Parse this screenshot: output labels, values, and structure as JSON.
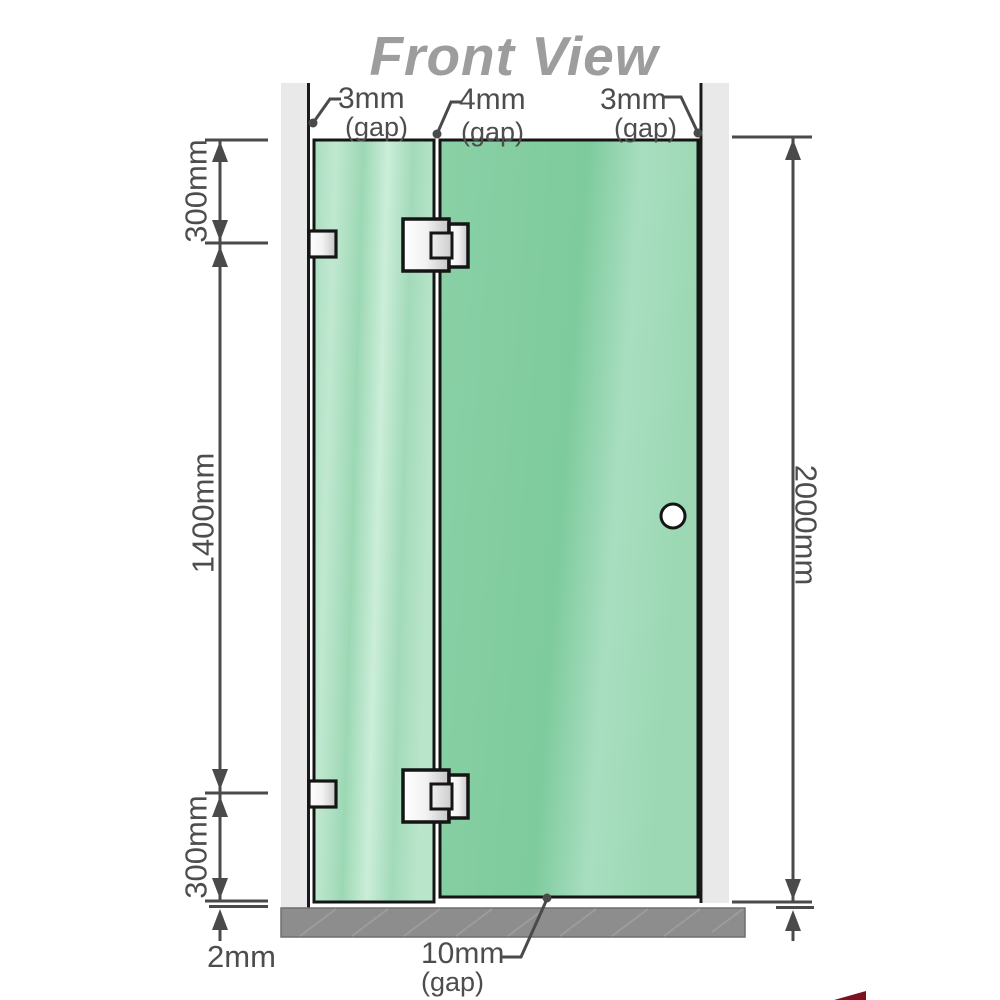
{
  "title": "Front View",
  "labels": {
    "gap_top_left": {
      "value": "3mm",
      "note": "(gap)"
    },
    "gap_top_middle": {
      "value": "4mm",
      "note": "(gap)"
    },
    "gap_top_right": {
      "value": "3mm",
      "note": "(gap)"
    },
    "gap_bottom": {
      "value": "10mm",
      "note": "(gap)"
    },
    "dim_left_top": "300mm",
    "dim_left_middle": "1400mm",
    "dim_left_bottom": "300mm",
    "dim_floor_gap": "2mm",
    "dim_right_height": "2000mm"
  },
  "colors": {
    "glass_green": "#7ecb9d",
    "glass_highlight": "#c6ebd4",
    "wall_gray": "#e9e9e9",
    "floor_gray": "#8d8d8d",
    "dimension_line": "#4a4a4a",
    "outline_black": "#151515",
    "title_gray": "#9d9d9d",
    "logo_red": "#7c1220"
  }
}
